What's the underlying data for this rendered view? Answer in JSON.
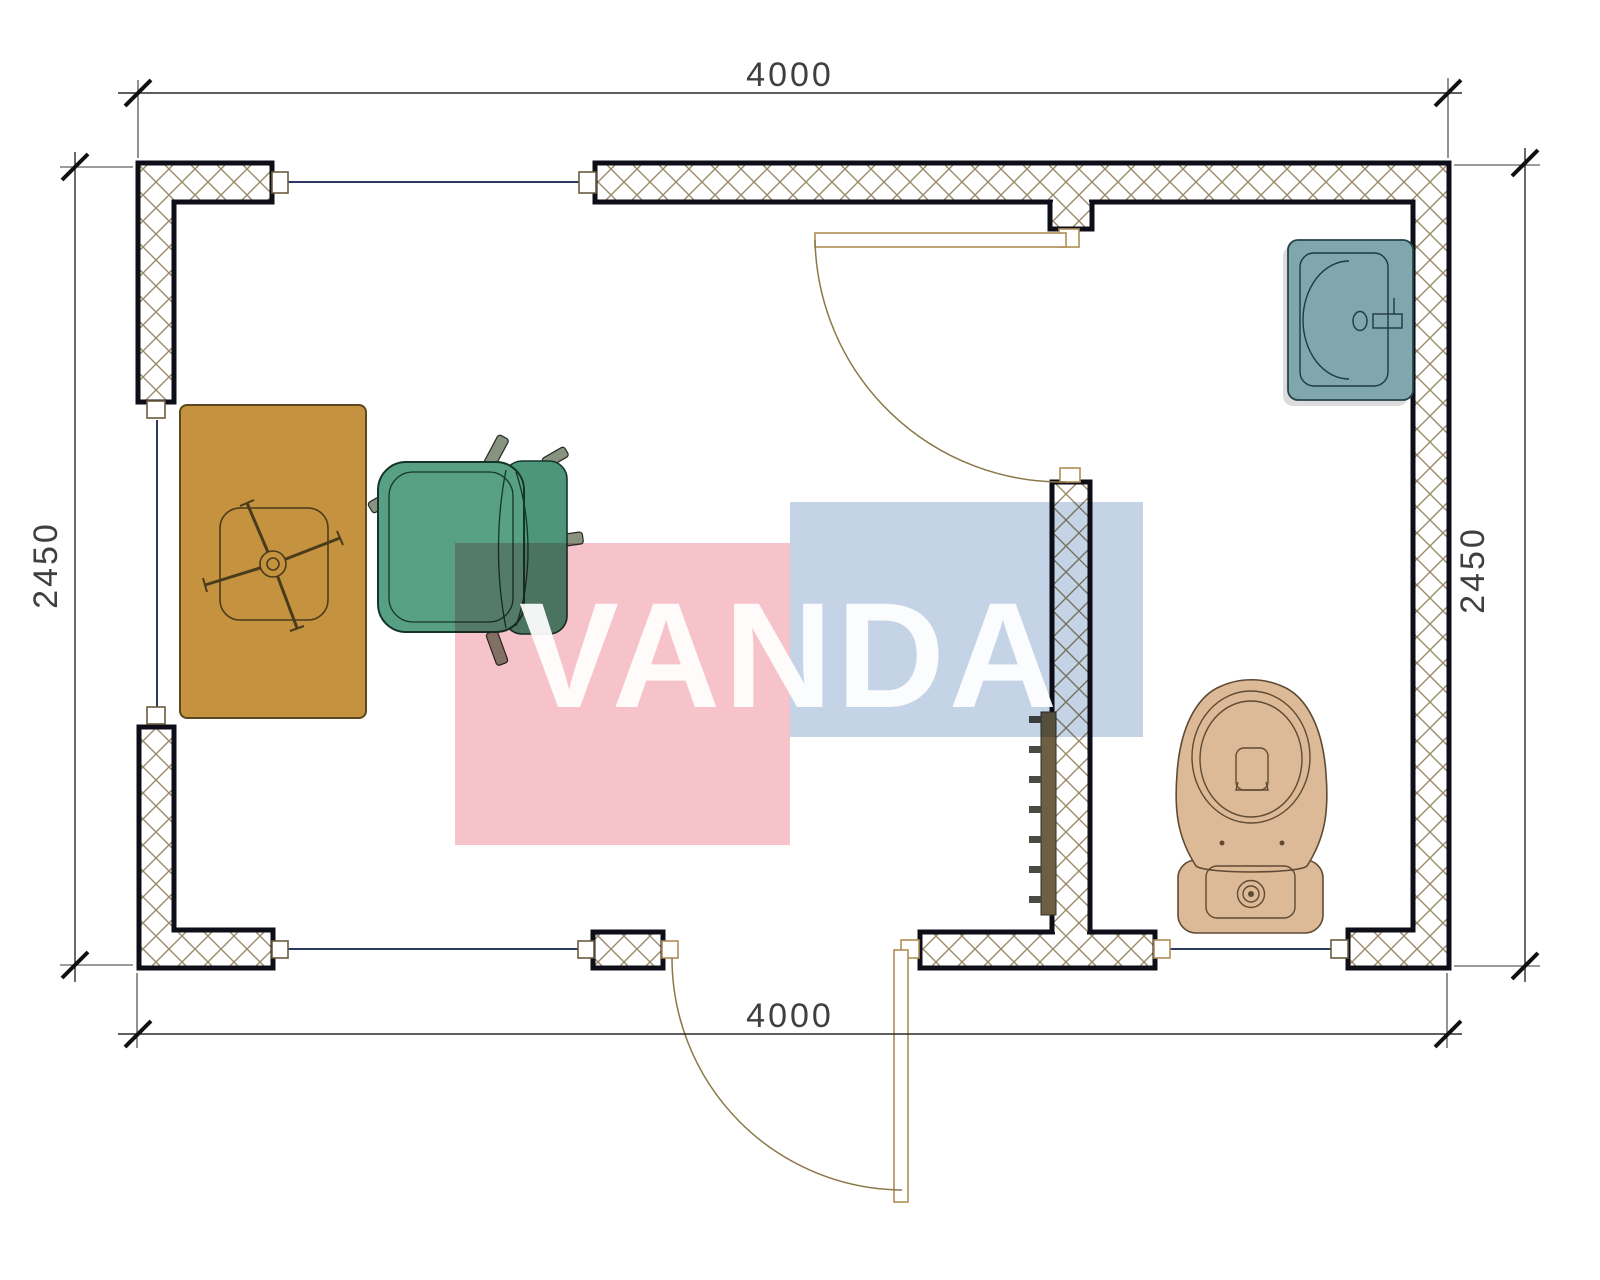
{
  "dimensions": {
    "top": "4000",
    "bottom": "4000",
    "left": "2450",
    "right": "2450"
  },
  "watermark": {
    "text": "VANDA"
  },
  "palette": {
    "wall_hatch": "#9a8a68",
    "wall_outline": "#0e0e18",
    "window_line": "#2B3A5E",
    "door_frame": "#B08D57",
    "desk": "#C59240",
    "chair": "#57A084",
    "caster": "#87937F",
    "toilet": "#DCBA97",
    "sink": "#7FA7AD",
    "radiator": "#6F5F42",
    "dim_line": "#2a2a2a",
    "dim_text": "#3f3f3f",
    "watermark_pink": "#F6C3CA",
    "watermark_blue": "#C4D3E6"
  },
  "fixture_icons": [
    "desk-icon",
    "office-chair-icon",
    "radiator-icon",
    "toilet-icon",
    "sink-icon",
    "door-swing-icon",
    "window-icon"
  ]
}
